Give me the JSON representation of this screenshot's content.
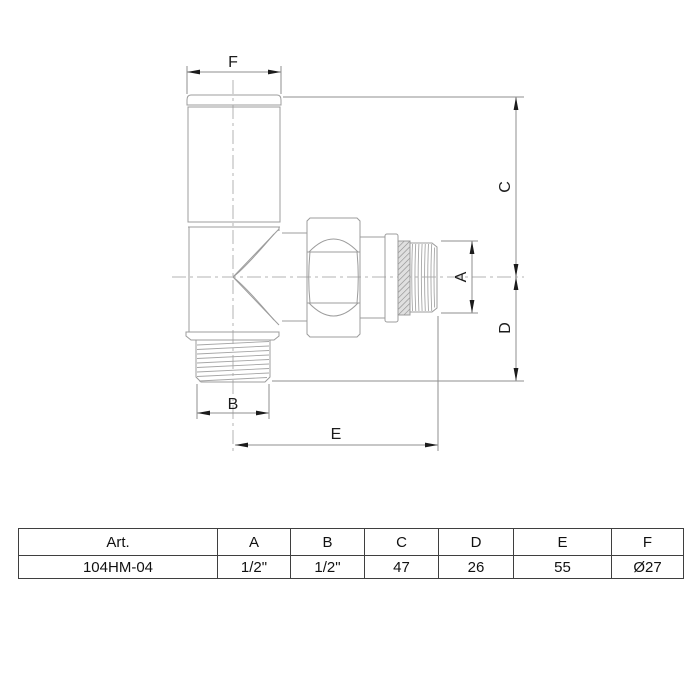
{
  "diagram": {
    "title": "angle-radiator-valve-technical-drawing",
    "dimension_labels": {
      "f": "F",
      "c": "C",
      "a": "A",
      "d": "D",
      "b": "B",
      "e": "E"
    }
  },
  "table": {
    "headers": [
      "Art.",
      "A",
      "B",
      "C",
      "D",
      "E",
      "F"
    ],
    "rows": [
      [
        "104HM-04",
        "1/2\"",
        "1/2\"",
        "47",
        "26",
        "55",
        "Ø27"
      ]
    ]
  },
  "colors": {
    "outline": "#9c9c9c",
    "thread": "#a6a6a6",
    "centerline": "#b3b3b3",
    "dimension_line": "#8f8f8f",
    "arrow_and_text": "#1c1c1c",
    "washer_fill": "#e0e0e0",
    "table_border": "#3f3f3f",
    "background": "#ffffff"
  }
}
